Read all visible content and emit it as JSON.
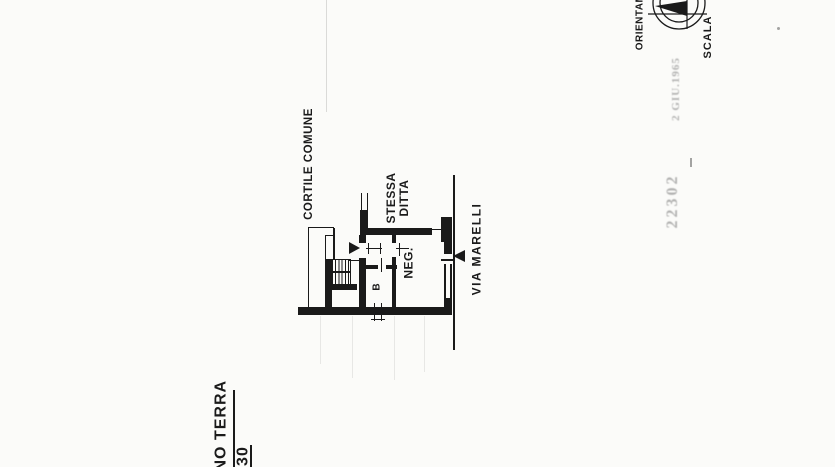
{
  "plan": {
    "labels": {
      "cortile": "CORTILE COMUNE",
      "stessa_line1": "STESSA",
      "stessa_line2": "DITTA",
      "neg": "NEG.",
      "b": "B",
      "via": "VIA MARELLI"
    }
  },
  "corner": {
    "orientation": "ORIENTAM",
    "scale": "SCALA"
  },
  "stamp": {
    "number": "22302",
    "date": "2 GIU.1965"
  },
  "footer": {
    "floor": "ANO TERRA",
    "number": "330"
  },
  "colors": {
    "ink": "#1a1a1a",
    "paper": "#fbfbf9",
    "stamp_ink": "#757575"
  }
}
